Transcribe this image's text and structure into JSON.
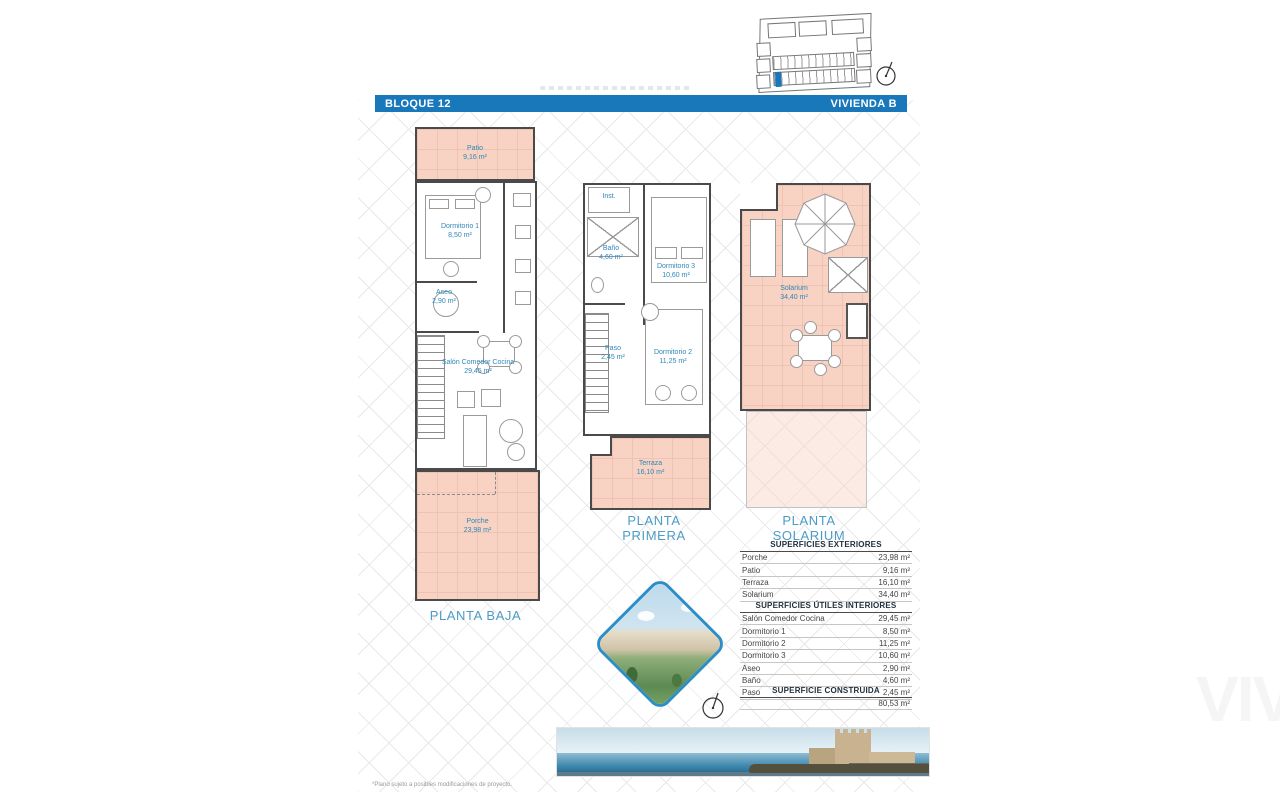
{
  "header": {
    "block": "BLOQUE 12",
    "unit": "VIVIENDA B"
  },
  "plans": {
    "baja": {
      "title": "PLANTA BAJA",
      "rooms": {
        "patio": {
          "name": "Patio",
          "area": "9,16 m²"
        },
        "dormitorio1": {
          "name": "Dormitorio 1",
          "area": "8,50 m²"
        },
        "aseo": {
          "name": "Aseo",
          "area": "2,90 m²"
        },
        "salon": {
          "name": "Salón Comedor Cocina",
          "area": "29,45 m²"
        },
        "porche": {
          "name": "Porche",
          "area": "23,98 m²"
        }
      }
    },
    "primera": {
      "title": "PLANTA PRIMERA",
      "rooms": {
        "inst": {
          "name": "Inst."
        },
        "bano": {
          "name": "Baño",
          "area": "4,60 m²"
        },
        "dormitorio3": {
          "name": "Dormitorio 3",
          "area": "10,60 m²"
        },
        "paso": {
          "name": "Paso",
          "area": "2,45 m²"
        },
        "dormitorio2": {
          "name": "Dormitorio 2",
          "area": "11,25 m²"
        },
        "terraza": {
          "name": "Terraza",
          "area": "16,10 m²"
        }
      }
    },
    "solarium": {
      "title": "PLANTA SOLARIUM",
      "rooms": {
        "solarium": {
          "name": "Solarium",
          "area": "34,40 m²"
        }
      }
    }
  },
  "tables": [
    {
      "title": "SUPERFICIES EXTERIORES",
      "rows": [
        [
          "Porche",
          "23,98 m²"
        ],
        [
          "Patio",
          "9,16 m²"
        ],
        [
          "Terraza",
          "16,10 m²"
        ],
        [
          "Solarium",
          "34,40 m²"
        ]
      ]
    },
    {
      "title": "SUPERFICIES ÚTILES INTERIORES",
      "rows": [
        [
          "Salón Comedor Cocina",
          "29,45 m²"
        ],
        [
          "Dormitorio 1",
          "8,50 m²"
        ],
        [
          "Dormitorio 2",
          "11,25 m²"
        ],
        [
          "Dormitorio 3",
          "10,60 m²"
        ],
        [
          "Aseo",
          "2,90 m²"
        ],
        [
          "Baño",
          "4,60 m²"
        ],
        [
          "Paso",
          "2,45 m²"
        ]
      ]
    },
    {
      "title": "SUPERFICIE CONSTRUIDA",
      "rows": [
        [
          "",
          "80,53 m²"
        ]
      ]
    }
  ],
  "footnote": "*Plano sujeto a posibles modificaciones de proyecto.",
  "watermark": "VIV",
  "colors": {
    "accent": "#1878ba",
    "label_blue": "#2f87b8",
    "salmon": "#f8d2c3"
  }
}
